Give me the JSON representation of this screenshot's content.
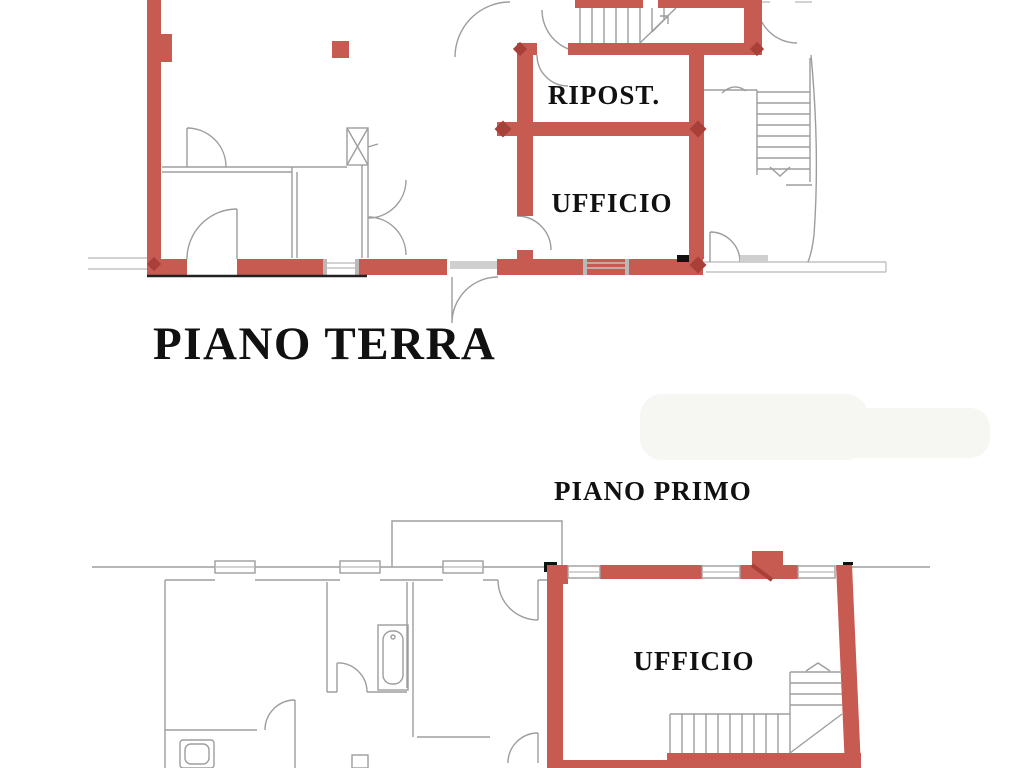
{
  "titles": {
    "ground": "PIANO TERRA",
    "first": "PIANO PRIMO"
  },
  "rooms": {
    "ground_storage": "RIPOST.",
    "ground_office": "UFFICIO",
    "first_office": "UFFICIO"
  },
  "colors": {
    "wall_highlight": "#c75a51",
    "wall_highlight_dark": "#a83f39",
    "line_gray": "#9d9d9d",
    "line_gray_light": "#c3c3c3",
    "text": "#111111",
    "background": "#ffffff"
  }
}
